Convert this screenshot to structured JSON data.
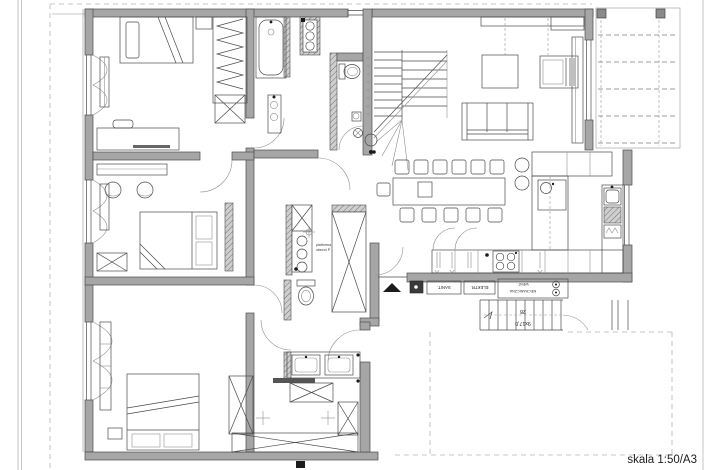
{
  "drawing": {
    "type": "apartment-floor-plan",
    "scale_label": "skala 1:50/A3"
  },
  "labels": {
    "utility_sanit": "SANIT.",
    "utility_elektr": "ELEKTR.",
    "vent_line1": "WENT.",
    "vent_line2": "MECHANICZNA",
    "platform_line1": "platforma",
    "platform_line2": "obecní P",
    "stair_tread": "28",
    "stair_riser": "9x17,0"
  },
  "colors": {
    "wall_gray": "#a6a6a6",
    "line_dark": "#4a4a4a",
    "line_light": "#8f8f8f",
    "dashed_boundary": "#b5b5b5",
    "entrance_arrow": "#1b1b1b",
    "paper": "#ffffff"
  }
}
